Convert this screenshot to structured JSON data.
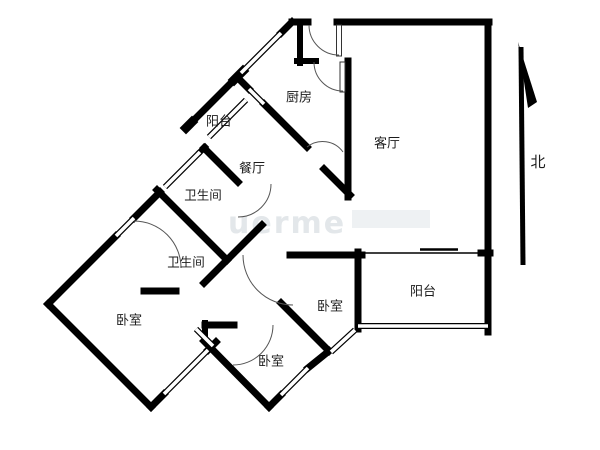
{
  "meta": {
    "type": "apartment-floor-plan",
    "background_color": "#ffffff",
    "wall_color": "#000000",
    "label_color": "#1c1c1c",
    "watermark_color": "#e3e7ea"
  },
  "rooms": [
    {
      "id": "kitchen",
      "label": "厨房",
      "x": 299,
      "y": 98
    },
    {
      "id": "balcony-nw",
      "label": "阳台",
      "x": 219,
      "y": 122
    },
    {
      "id": "dining",
      "label": "餐厅",
      "x": 252,
      "y": 169
    },
    {
      "id": "bathroom-1",
      "label": "卫生间",
      "x": 203,
      "y": 195
    },
    {
      "id": "bathroom-2",
      "label": "卫生间",
      "x": 186,
      "y": 262
    },
    {
      "id": "bedroom-west",
      "label": "卧室",
      "x": 129,
      "y": 321
    },
    {
      "id": "bedroom-south",
      "label": "卧室",
      "x": 271,
      "y": 362
    },
    {
      "id": "bedroom-east",
      "label": "卧室",
      "x": 330,
      "y": 307
    },
    {
      "id": "living-room",
      "label": "客厅",
      "x": 387,
      "y": 144
    },
    {
      "id": "balcony-se",
      "label": "阳台",
      "x": 423,
      "y": 292
    }
  ],
  "compass": {
    "label": "北"
  },
  "watermark": {
    "text": "uerme"
  }
}
